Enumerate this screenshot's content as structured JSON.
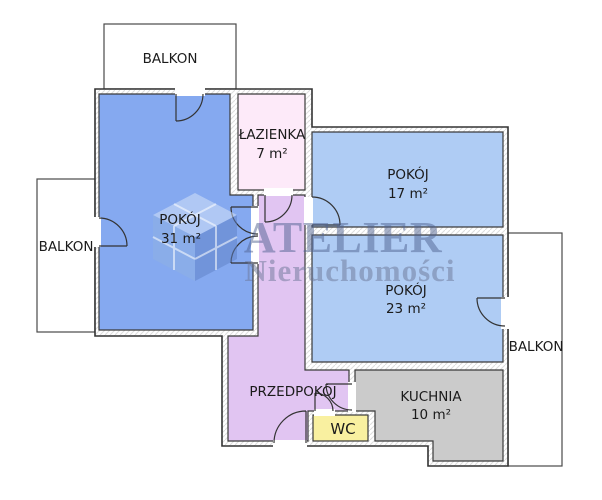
{
  "watermark": {
    "line1": "ATELIER",
    "line2": "Nieruchomości",
    "line1_color": "#4f618f",
    "line2_color": "#6b7695",
    "cube_top_color": "#dbe7f8",
    "cube_left_color": "#8fb2e2",
    "cube_right_color": "#5d80c4"
  },
  "text_color": "#1b1b1b",
  "rooms": {
    "balkon_top": {
      "label": "BALKON"
    },
    "balkon_left": {
      "label": "BALKON"
    },
    "balkon_right": {
      "label": "BALKON"
    },
    "pokoj31": {
      "label": "POKÓJ",
      "area": "31 m²",
      "color": "#85a9f0"
    },
    "lazienka": {
      "label": "ŁAZIENKA",
      "area": "7 m²",
      "color": "#fdeaf9"
    },
    "pokoj17": {
      "label": "POKÓJ",
      "area": "17 m²",
      "color": "#afccf4"
    },
    "pokoj23": {
      "label": "POKÓJ",
      "area": "23 m²",
      "color": "#afccf4"
    },
    "przedpokoj": {
      "label": "PRZEDPOKÓJ",
      "color": "#e1c5f2"
    },
    "wc": {
      "label": "WC",
      "color": "#f9f0a0"
    },
    "kuchnia": {
      "label": "KUCHNIA",
      "area": "10 m²",
      "color": "#cbcbcb"
    }
  }
}
